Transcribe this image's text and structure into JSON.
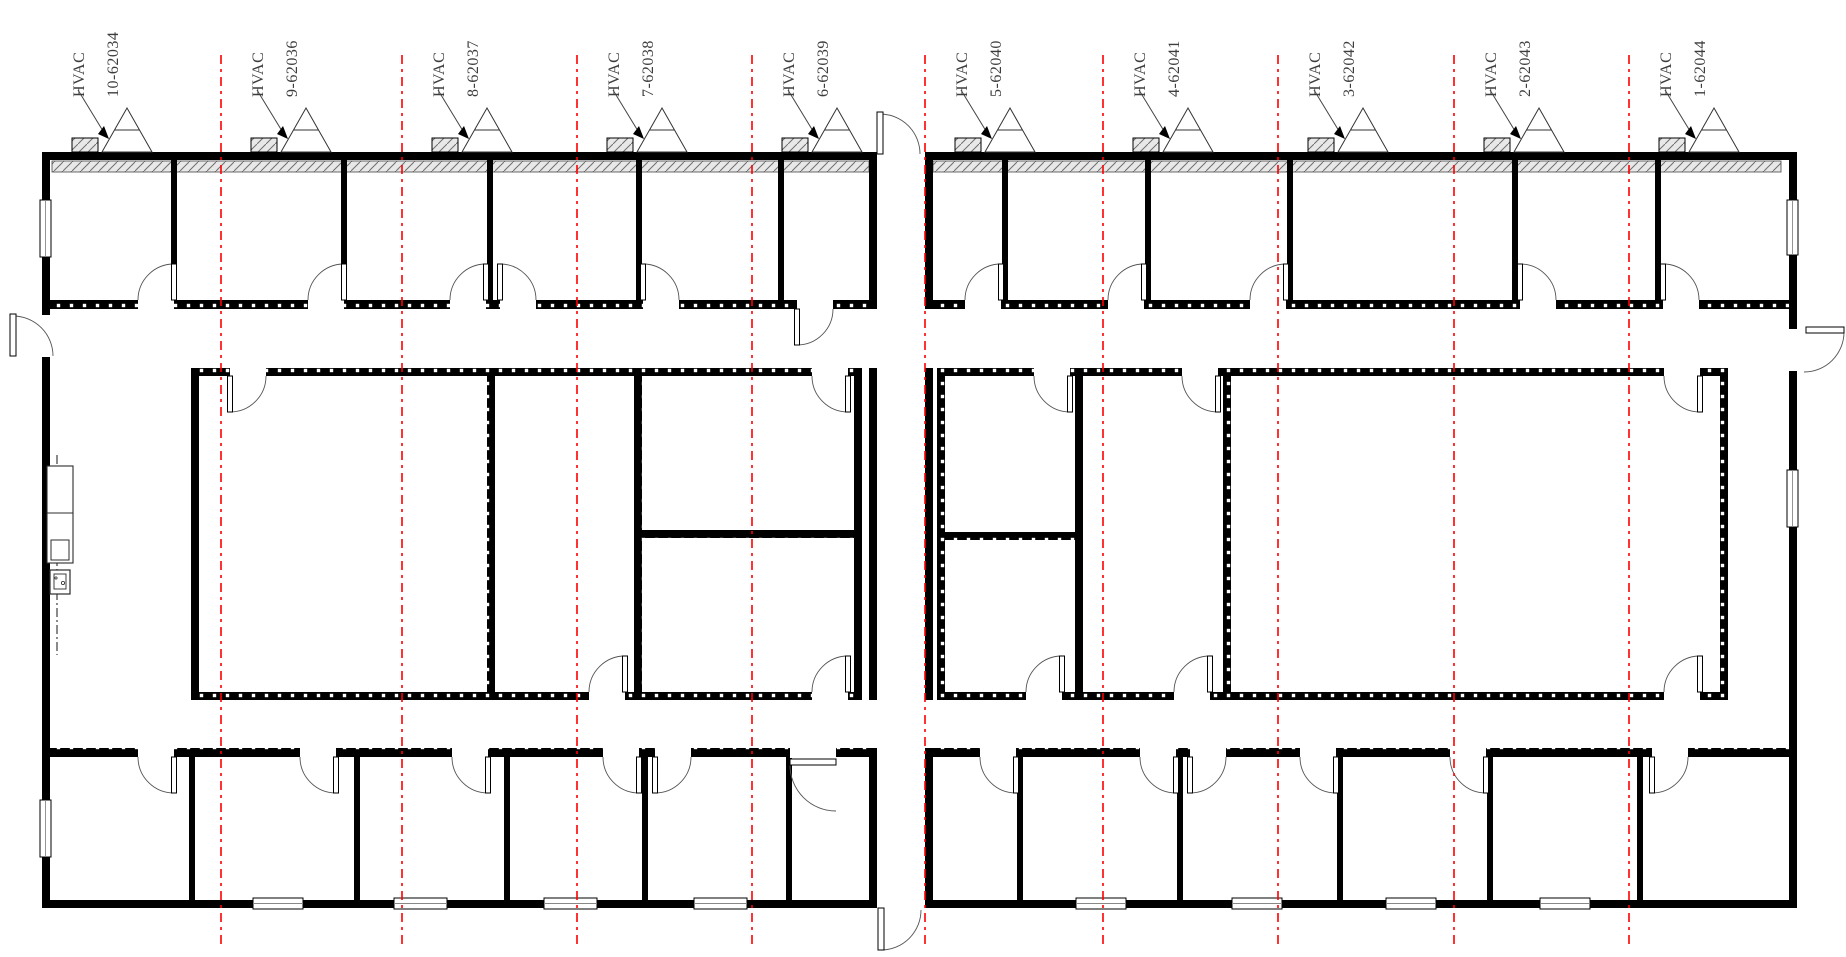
{
  "drawing": {
    "kind": "modular-building-floor-plan",
    "annotation_style": "rotated-leader-labels"
  },
  "colors": {
    "wall": "#000000",
    "match_line": "#ff0000",
    "annotation_text": "#3d3d3d",
    "hatch_background": "#e8e8e8",
    "hatch_line": "#6f6f6f",
    "door_arc": "#555555"
  },
  "match_lines": {
    "count": 9,
    "style": "red-dashed-vertical"
  },
  "hvac_units": [
    {
      "label": "HVAC",
      "id": "10-62034"
    },
    {
      "label": "HVAC",
      "id": "9-62036"
    },
    {
      "label": "HVAC",
      "id": "8-62037"
    },
    {
      "label": "HVAC",
      "id": "7-62038"
    },
    {
      "label": "HVAC",
      "id": "6-62039"
    },
    {
      "label": "HVAC",
      "id": "5-62040"
    },
    {
      "label": "HVAC",
      "id": "4-62041"
    },
    {
      "label": "HVAC",
      "id": "3-62042"
    },
    {
      "label": "HVAC",
      "id": "2-62043"
    },
    {
      "label": "HVAC",
      "id": "1-62044"
    }
  ]
}
